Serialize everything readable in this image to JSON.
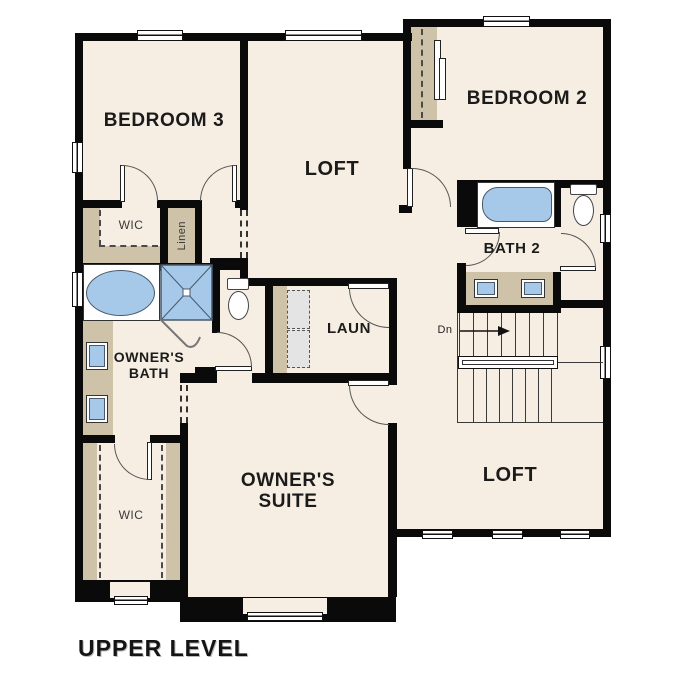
{
  "plan_title": "UPPER LEVEL",
  "rooms": {
    "bedroom3": "BEDROOM 3",
    "loft_upper": "LOFT",
    "bedroom2": "BEDROOM 2",
    "wic_upper": "WIC",
    "linen": "Linen",
    "owners_bath": "OWNER'S BATH",
    "bath2": "BATH 2",
    "laundry": "LAUN",
    "owners_suite": "OWNER'S SUITE",
    "wic_lower": "WIC",
    "loft_lower": "LOFT"
  },
  "stairs": {
    "direction_label": "Dn"
  },
  "colors": {
    "floor": "#f6eee2",
    "wall": "#0a0a0a",
    "casework_tan": "#cec2a8",
    "fixture_blue": "#a7c9e9",
    "appliance_gray": "#e4e4e4",
    "background": "#ffffff"
  }
}
